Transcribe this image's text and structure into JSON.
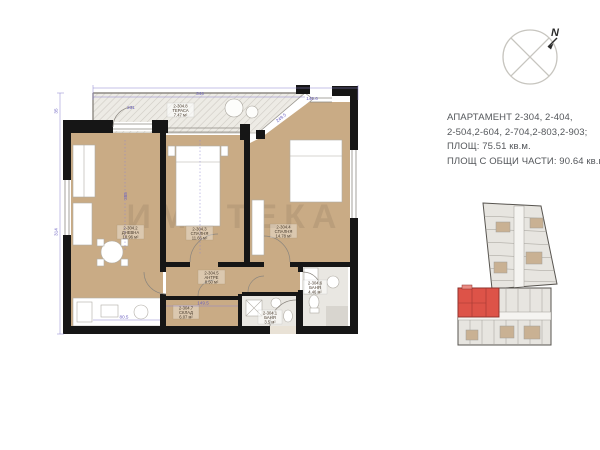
{
  "info_panel": {
    "line1": "АПАРТАМЕНТ  2-304, 2-404,",
    "line2": "2-504,2-604, 2-704,2-803,2-903;",
    "line3": "ПЛОЩ: 75.51 кв.м.",
    "line4": "ПЛОЩ С ОБЩИ ЧАСТИ: 90.64 кв.м."
  },
  "compass": {
    "north_label": "N"
  },
  "floor_plan": {
    "watermark": "ИМОТЕКА",
    "rooms": [
      {
        "number": "2-304.8",
        "name": "ТЕРАСА",
        "area": "7.47 м²"
      },
      {
        "number": "2-304.2",
        "name": "ДНЕВНА",
        "area": "18.96 м²"
      },
      {
        "number": "2-304.3",
        "name": "СПАЛНЯ",
        "area": "11.66 м²"
      },
      {
        "number": "2-304.4",
        "name": "СПАЛНЯ",
        "area": "14.78 м²"
      },
      {
        "number": "2-304.5",
        "name": "АНТРЕ",
        "area": "8.50 м²"
      },
      {
        "number": "2-304.6",
        "name": "БАНЯ",
        "area": "4.46 м²"
      },
      {
        "number": "2-304.7",
        "name": "СКЛАД",
        "area": "6.07 м²"
      },
      {
        "number": "2-304.1",
        "name": "БАНЯ",
        "area": "3.5 м²"
      }
    ],
    "dimensions": [
      "344",
      "231",
      "140.6",
      "249.5",
      "35",
      "314",
      "385",
      "149.5",
      "80.5"
    ],
    "colors": {
      "room_fill": "#c9ab85",
      "wall": "#161616",
      "dimension": "#6a5fc0",
      "terrace_fill": "#edebe5",
      "highlight_unit": "#dd5348"
    }
  }
}
